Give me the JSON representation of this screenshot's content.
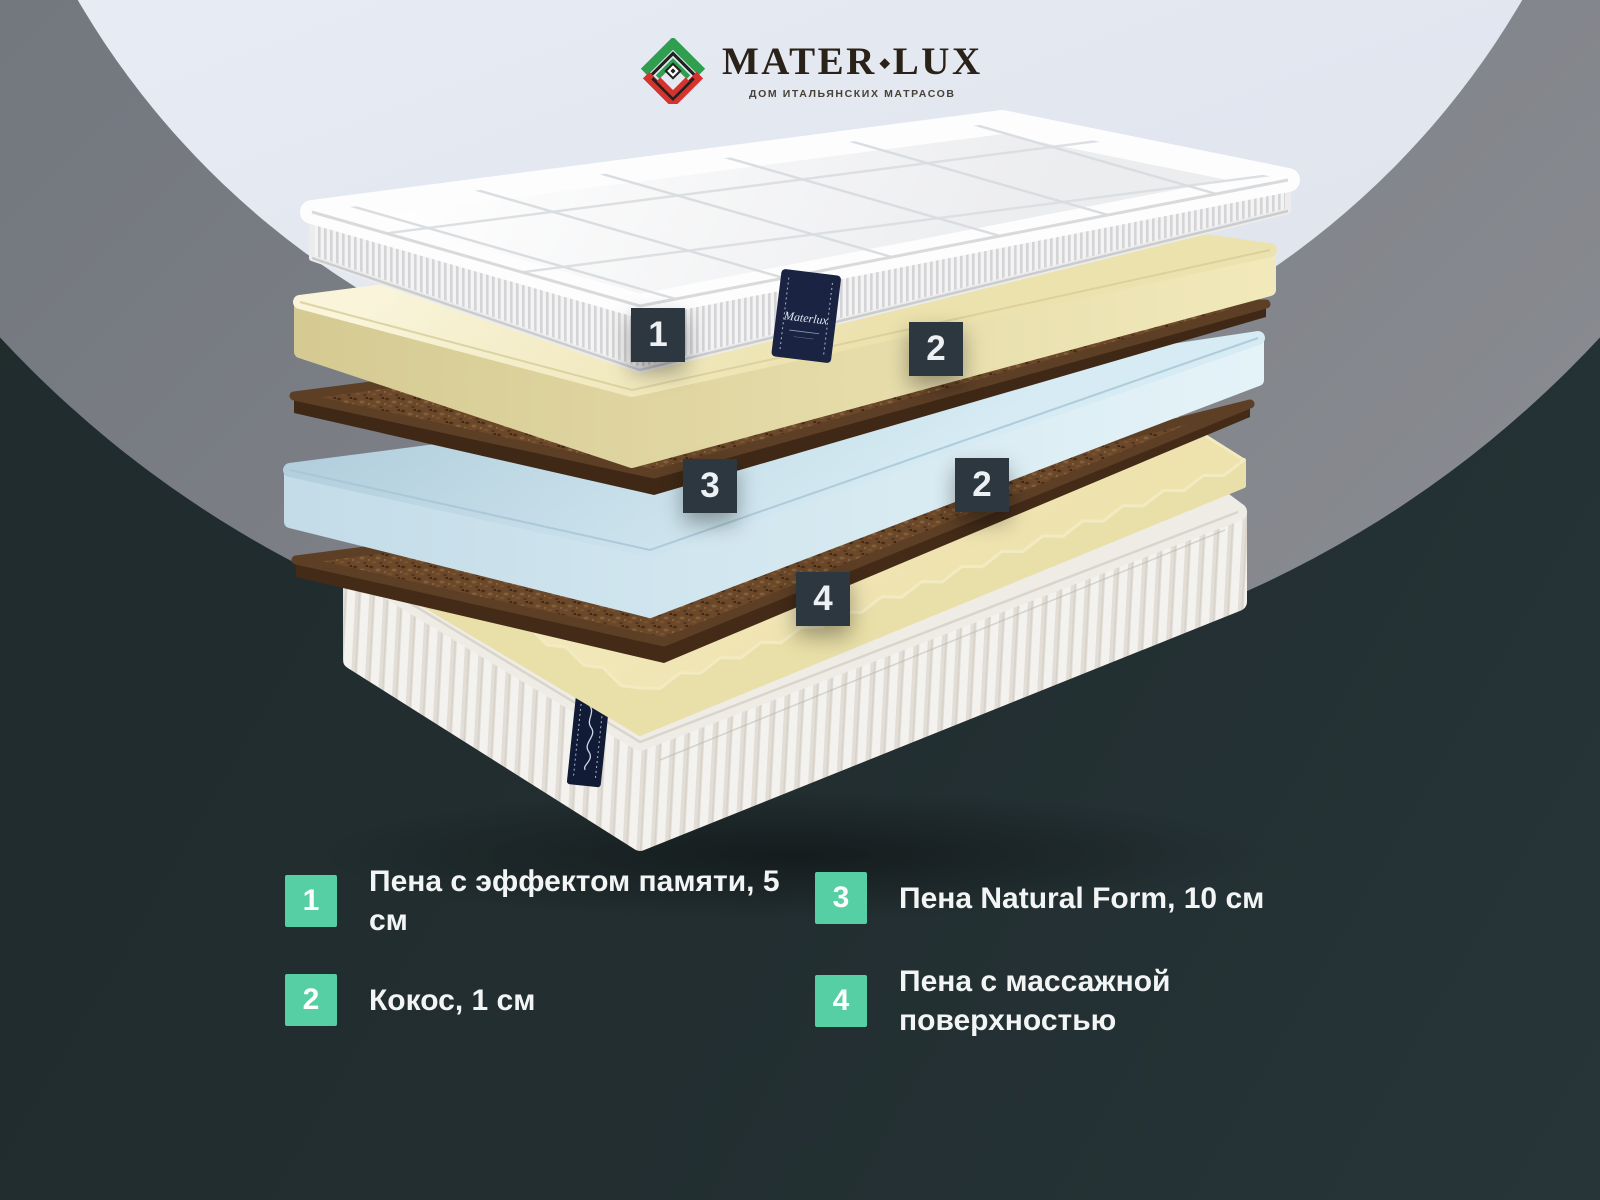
{
  "logo": {
    "brand_left": "MATER",
    "brand_separator": "◆",
    "brand_right": "LUX",
    "tagline": "ДОМ ИТАЛЬЯНСКИХ МАТРАСОВ"
  },
  "product_tag": {
    "text": "Materlux"
  },
  "diagram": {
    "callouts": [
      {
        "number": "1"
      },
      {
        "number": "2"
      },
      {
        "number": "3"
      },
      {
        "number": "2"
      },
      {
        "number": "4"
      }
    ]
  },
  "legend": {
    "items": [
      {
        "number": "1",
        "label": "Пена с эффектом памяти, 5 см"
      },
      {
        "number": "2",
        "label": "Кокос, 1 см"
      },
      {
        "number": "3",
        "label": "Пена Natural Form, 10 см"
      },
      {
        "number": "4",
        "label": "Пена с массажной поверхностью"
      }
    ]
  },
  "colors": {
    "accent_teal": "#57cfa4",
    "callout_dark": "#2c3740",
    "background_dark": "#222e30",
    "circle_gray": "#74787f",
    "circle_light": "#e8ecf4",
    "memory_foam_cream": "#f1e9bd",
    "coconut_brown": "#6a4829",
    "natural_form_blue": "#c7dfeb",
    "label_navy": "#1a2342"
  }
}
